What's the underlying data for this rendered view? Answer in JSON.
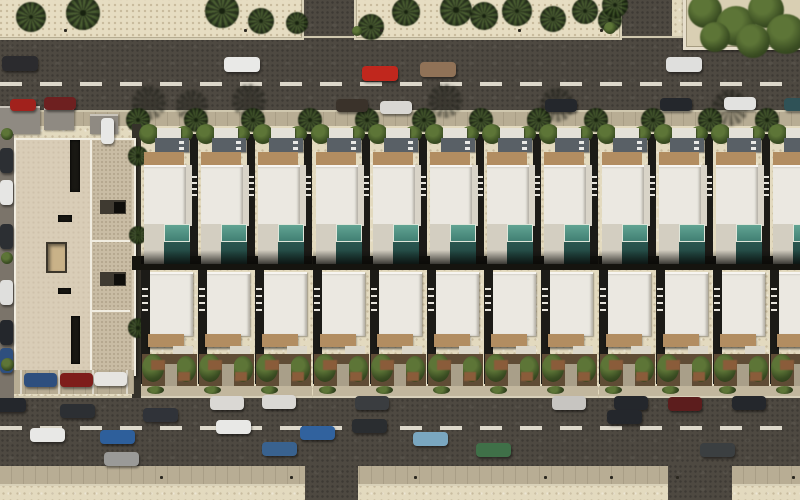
{
  "scene": {
    "width": 800,
    "height": 500,
    "description": "aerial-render-of-villa-row-development",
    "title": "aerial-residential-render"
  },
  "palette": {
    "sand": "#e3dabf",
    "road": "#4e4941",
    "roadLine": "#ddd8cb",
    "sidewalk": "#b8ad94",
    "curb": "#cfc7ae",
    "buildingBeige": "#d9cdb7",
    "buildingWing": "#c9bca4",
    "buildingEdge": "#f1ede1",
    "roofWhite": "#ebe8e1",
    "roofSide": "#d9d4c8",
    "deck": "#d3cec1",
    "slab": "#dcd7ca",
    "poolLight": "#57998a",
    "poolDark": "#27534c",
    "pergola": "#b28d61",
    "canopy": "#596066",
    "gardenSoil": "#5f4c35",
    "gardenGreen": "#4d5f2c",
    "gardenRust": "#8a5c3a",
    "path": "#a99f89",
    "alley": "#35322a",
    "laneLeft": "#7b746a",
    "shadow": "#15140f",
    "frontStrip": "#c2b79e",
    "grayRoof": "#8f8a82"
  },
  "roads": {
    "top": {
      "x": 0,
      "y": 36,
      "w": 800,
      "h": 76,
      "dashY": 82
    },
    "bottom": {
      "x": 0,
      "y": 396,
      "w": 800,
      "h": 70,
      "dashY": 426
    },
    "topBranches": [
      {
        "x": 300,
        "y": 0,
        "w": 54,
        "h": 40
      },
      {
        "x": 620,
        "y": 0,
        "w": 52,
        "h": 40
      }
    ],
    "bottomBranches": [
      {
        "x": 305,
        "y": 464,
        "w": 53,
        "h": 36
      },
      {
        "x": 668,
        "y": 464,
        "w": 64,
        "h": 36
      }
    ],
    "leftLane": {
      "x": 0,
      "y": 108,
      "w": 14,
      "h": 290
    },
    "topSidewalk": {
      "x": 0,
      "y": 110,
      "w": 800,
      "h": 14
    },
    "bottomSidewalk": {
      "x": 0,
      "y": 466,
      "w": 800,
      "h": 18
    },
    "bottomSandY": 484
  },
  "sandBlocks": [
    {
      "x": -4,
      "y": -6,
      "w": 304,
      "h": 42
    },
    {
      "x": 354,
      "y": -6,
      "w": 264,
      "h": 42
    }
  ],
  "planter": {
    "x": 683,
    "y": -6,
    "w": 120,
    "h": 50
  },
  "canopyTrees": [
    {
      "x": 688,
      "y": -6,
      "d": 34
    },
    {
      "x": 716,
      "y": 6,
      "d": 40
    },
    {
      "x": 748,
      "y": -8,
      "d": 36
    },
    {
      "x": 766,
      "y": 14,
      "d": 40
    },
    {
      "x": 700,
      "y": 22,
      "d": 30
    },
    {
      "x": 736,
      "y": 24,
      "d": 34
    }
  ],
  "palmsTop": [
    {
      "x": 16,
      "y": 2,
      "d": 30
    },
    {
      "x": 66,
      "y": -4,
      "d": 34
    },
    {
      "x": 205,
      "y": -6,
      "d": 34
    },
    {
      "x": 248,
      "y": 8,
      "d": 26
    },
    {
      "x": 286,
      "y": 12,
      "d": 22
    },
    {
      "x": 358,
      "y": 14,
      "d": 26
    },
    {
      "x": 392,
      "y": -2,
      "d": 28
    },
    {
      "x": 440,
      "y": -6,
      "d": 32
    },
    {
      "x": 470,
      "y": 2,
      "d": 28
    },
    {
      "x": 502,
      "y": -4,
      "d": 30
    },
    {
      "x": 540,
      "y": 6,
      "d": 26
    },
    {
      "x": 572,
      "y": -2,
      "d": 26
    },
    {
      "x": 598,
      "y": 8,
      "d": 24
    },
    {
      "x": 602,
      "y": -8,
      "d": 26
    }
  ],
  "bushesTop": [
    {
      "x": 604,
      "y": 22,
      "d": 12
    },
    {
      "x": 352,
      "y": 26,
      "d": 10
    }
  ],
  "sidewalkPalms": {
    "y": 108,
    "d": 24,
    "xs": [
      138,
      196,
      253,
      310,
      367,
      424,
      481,
      539,
      596,
      653,
      710,
      767
    ]
  },
  "palmShadows": [
    {
      "x": 132,
      "y": 86,
      "d": 34
    },
    {
      "x": 176,
      "y": 90,
      "d": 32
    },
    {
      "x": 232,
      "y": 84,
      "d": 34
    },
    {
      "x": 428,
      "y": 84,
      "d": 34
    },
    {
      "x": 540,
      "y": 88,
      "d": 34
    },
    {
      "x": 712,
      "y": 90,
      "d": 36
    }
  ],
  "bollardsTop": {
    "y": 29,
    "xs": [
      64,
      244,
      380,
      518,
      600
    ]
  },
  "bollardsBottom": {
    "y": 476,
    "xs": [
      160,
      290,
      414,
      544,
      610,
      676,
      792
    ]
  },
  "housing": {
    "startX": 141,
    "pitch": 57.2,
    "count": 12,
    "upperY": 124,
    "upperH": 140,
    "alley": {
      "x": 132,
      "y": 256,
      "w": 668,
      "h": 14
    },
    "lowerY": 268,
    "lowerH": 130
  },
  "building": {
    "x": 14,
    "y": 138,
    "w": 118,
    "h": 234,
    "wingX": 88,
    "parapets": [
      238,
      308
    ],
    "slots": [
      {
        "x": 70,
        "y": 140,
        "w": 10,
        "h": 52
      },
      {
        "x": 58,
        "y": 215,
        "w": 14,
        "h": 7
      },
      {
        "x": 58,
        "y": 288,
        "w": 13,
        "h": 6
      },
      {
        "x": 71,
        "y": 316,
        "w": 9,
        "h": 48
      }
    ],
    "courtyard": {
      "x": 46,
      "y": 242,
      "w": 17,
      "h": 27
    },
    "notches": [
      {
        "x": 100,
        "y": 200,
        "w": 26,
        "h": 14
      },
      {
        "x": 100,
        "y": 272,
        "w": 26,
        "h": 14
      }
    ],
    "darkSquares": [
      {
        "x": 114,
        "y": 202,
        "w": 11,
        "h": 11
      },
      {
        "x": 114,
        "y": 274,
        "w": 11,
        "h": 11
      }
    ],
    "frontBoxes": [
      {
        "x": 0,
        "y": 106,
        "w": 40,
        "h": 26
      },
      {
        "x": 44,
        "y": 108,
        "w": 30,
        "h": 20
      },
      {
        "x": 90,
        "y": 114,
        "w": 28,
        "h": 18
      }
    ],
    "alleyStrip": {
      "x": 132,
      "y": 124,
      "w": 9,
      "h": 274
    },
    "alleyPalms": [
      {
        "x": 128,
        "y": 146,
        "d": 20
      },
      {
        "x": 129,
        "y": 226,
        "d": 18
      },
      {
        "x": 128,
        "y": 318,
        "d": 20
      }
    ],
    "parking": {
      "y": 370,
      "h": 24,
      "lineXs": [
        20,
        58,
        92,
        126
      ],
      "cars": [
        {
          "x": 24,
          "y": 373,
          "body": "#2e4f7e"
        },
        {
          "x": 60,
          "y": 373,
          "body": "#7e1d1a"
        },
        {
          "x": 94,
          "y": 372,
          "body": "#e6e5e1"
        }
      ]
    }
  },
  "leftColumn": {
    "cars": [
      {
        "y": 148,
        "body": "#2c2f33"
      },
      {
        "y": 180,
        "body": "#e6e6e4"
      },
      {
        "y": 224,
        "body": "#2c2f33"
      },
      {
        "y": 280,
        "body": "#dfdfdd"
      },
      {
        "y": 320,
        "body": "#24272c"
      },
      {
        "y": 348,
        "body": "#2e4f7e"
      }
    ],
    "bushes": [
      {
        "y": 128,
        "d": 12
      },
      {
        "y": 252,
        "d": 12
      },
      {
        "y": 358,
        "d": 13
      }
    ]
  },
  "cars": {
    "topMoving": [
      {
        "x": 2,
        "y": 56,
        "body": "#2b2b2e"
      },
      {
        "x": 224,
        "y": 57,
        "body": "#e9e9e7"
      },
      {
        "x": 420,
        "y": 62,
        "body": "#907257"
      },
      {
        "x": 362,
        "y": 66,
        "body": "#c0271d"
      },
      {
        "x": 666,
        "y": 57,
        "body": "#dfdfdd"
      }
    ],
    "topParked": [
      {
        "x": 44,
        "y": 97,
        "body": "#6e2020"
      },
      {
        "x": 336,
        "y": 99,
        "body": "#3a322a"
      },
      {
        "x": 380,
        "y": 101,
        "body": "#d9d7d3"
      },
      {
        "x": 545,
        "y": 99,
        "body": "#24272c"
      },
      {
        "x": 660,
        "y": 98,
        "body": "#24272c"
      },
      {
        "x": 724,
        "y": 97,
        "body": "#e2e2e0"
      },
      {
        "x": 784,
        "y": 98,
        "body": "#2f5257"
      }
    ],
    "specials": {
      "redCorner": {
        "x": 10,
        "y": 99,
        "body": "#a1211c"
      },
      "whiteVan": {
        "x": 101,
        "y": 118,
        "body": "#e8e8e6"
      }
    },
    "bottomParked": [
      {
        "x": -8,
        "y": 398,
        "body": "#24272c"
      },
      {
        "x": 210,
        "y": 396,
        "body": "#dad8d4"
      },
      {
        "x": 262,
        "y": 395,
        "body": "#dad8d4"
      },
      {
        "x": 355,
        "y": 396,
        "body": "#3a3d40"
      },
      {
        "x": 552,
        "y": 396,
        "body": "#c7c5c1"
      },
      {
        "x": 614,
        "y": 396,
        "body": "#24272c"
      },
      {
        "x": 668,
        "y": 397,
        "body": "#5c1d1d"
      },
      {
        "x": 732,
        "y": 396,
        "body": "#24272c"
      }
    ],
    "bottomMoving": [
      {
        "x": 60,
        "y": 404,
        "body": "#2c2f33"
      },
      {
        "x": 143,
        "y": 408,
        "body": "#303339"
      },
      {
        "x": 216,
        "y": 420,
        "body": "#e8e8e6"
      },
      {
        "x": 352,
        "y": 419,
        "body": "#2a2d30"
      },
      {
        "x": 607,
        "y": 410,
        "body": "#24272c"
      },
      {
        "x": 30,
        "y": 428,
        "body": "#e8e8e6"
      },
      {
        "x": 100,
        "y": 430,
        "body": "#2e5f9b"
      },
      {
        "x": 104,
        "y": 452,
        "body": "#9a9a98"
      },
      {
        "x": 262,
        "y": 442,
        "body": "#39628f"
      },
      {
        "x": 300,
        "y": 426,
        "body": "#31629e"
      },
      {
        "x": 413,
        "y": 432,
        "body": "#7aa7c0"
      },
      {
        "x": 476,
        "y": 443,
        "body": "#3f7048"
      },
      {
        "x": 700,
        "y": 443,
        "body": "#3b3f41"
      }
    ]
  }
}
